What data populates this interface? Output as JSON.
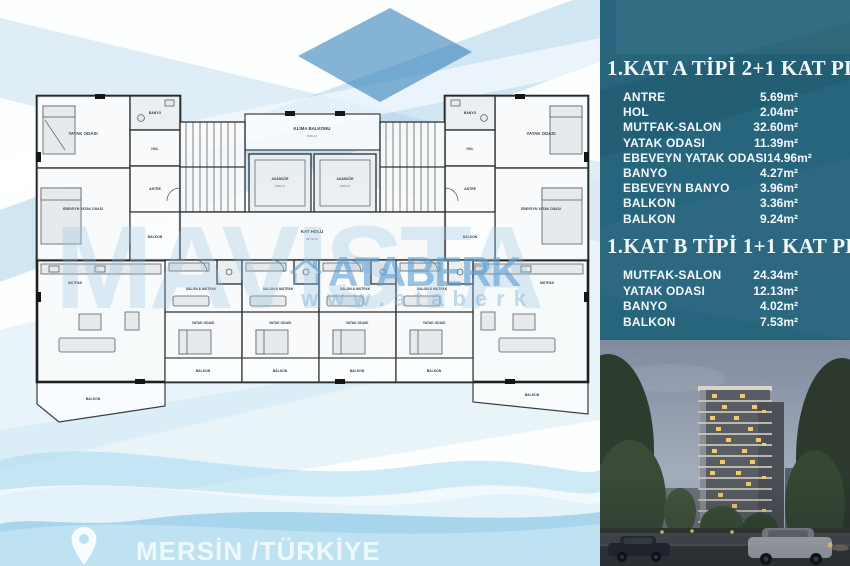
{
  "watermark": {
    "big_text": "MAVISTA",
    "brand": "ATABERK",
    "url": "www.ataberk"
  },
  "location": {
    "text": "MERSİN /TÜRKİYE"
  },
  "floorplan": {
    "core": {
      "klima_balkonu": "KLİMA BALKONU",
      "klima_area": "5.06 m²",
      "asansor": "ASANSÖR",
      "asansor_area": "5.06 m²",
      "kat_holu": "KAT HOLÜ",
      "kat_holu_area": "32.70 m²"
    },
    "apartment_a": {
      "yatak": "YATAK ODASI",
      "ebeveyn": "EBEVEYN YATAK ODASI",
      "banyo": "BANYO",
      "hol": "HOL",
      "antre": "ANTRE",
      "balkon": "BALKON",
      "mutfak": "MUTFAK"
    },
    "apartment_b": {
      "salon_mutfak": "SALON & MUTFAK",
      "yatak": "YATAK ODASI",
      "balkon": "BALKON"
    }
  },
  "panel": {
    "bg_color": "#26657c",
    "section_a": {
      "title": "1.KAT A TİPİ 2+1 KAT PLANI",
      "rows": [
        {
          "label": "ANTRE",
          "value": "5.69m²"
        },
        {
          "label": "HOL",
          "value": "2.04m²"
        },
        {
          "label": "MUTFAK-SALON",
          "value": "32.60m²"
        },
        {
          "label": "YATAK ODASI",
          "value": "11.39m²"
        },
        {
          "label": "EBEVEYN YATAK ODASI",
          "value": "14.96m²"
        },
        {
          "label": "BANYO",
          "value": "4.27m²"
        },
        {
          "label": "EBEVEYN BANYO",
          "value": "3.96m²"
        },
        {
          "label": "BALKON",
          "value": "3.36m²"
        },
        {
          "label": "BALKON",
          "value": "9.24m²"
        }
      ]
    },
    "section_b": {
      "title": "1.KAT B TİPİ 1+1 KAT PLANI",
      "rows": [
        {
          "label": "MUTFAK-SALON",
          "value": "24.34m²"
        },
        {
          "label": "YATAK ODASI",
          "value": "12.13m²"
        },
        {
          "label": "BANYO",
          "value": "4.02m²"
        },
        {
          "label": "BALKON",
          "value": "7.53m²"
        }
      ]
    }
  }
}
